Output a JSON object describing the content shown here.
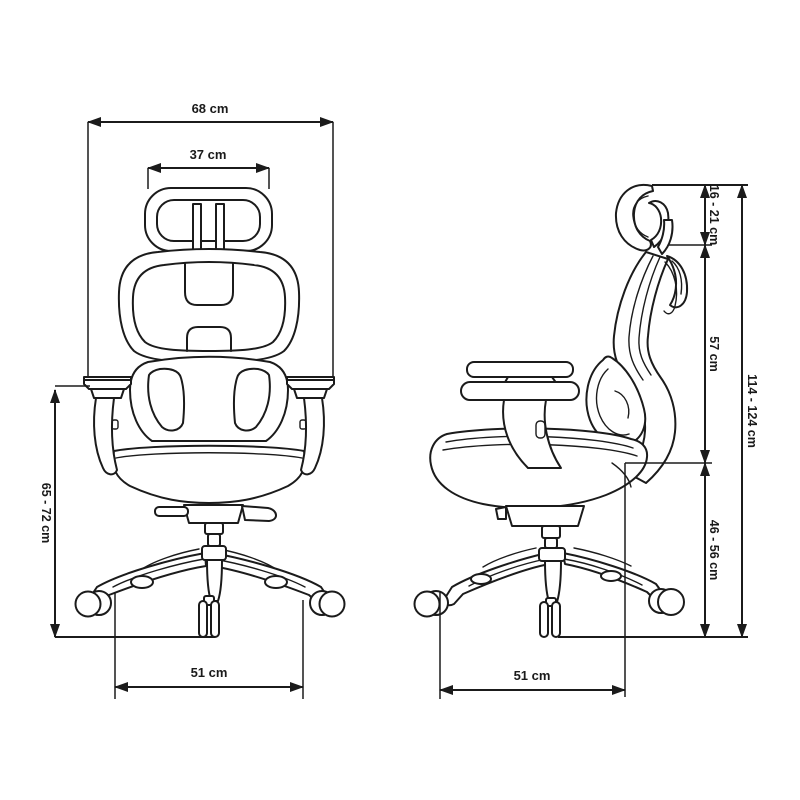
{
  "colors": {
    "line": "#1b1b1b",
    "background": "#ffffff",
    "text": "#1a1a1a"
  },
  "dimensions": {
    "overall_width": {
      "label": "68 cm"
    },
    "headrest_width": {
      "label": "37 cm"
    },
    "armrest_height_range": {
      "label": "65 - 72 cm"
    },
    "front_base_width": {
      "label": "51 cm"
    },
    "headrest_adjust_range": {
      "label": "16 - 21 cm"
    },
    "backrest_height": {
      "label": "57 cm"
    },
    "overall_height_range": {
      "label": "114 - 124 cm"
    },
    "seat_height_range": {
      "label": "46 - 56 cm"
    },
    "side_base_depth": {
      "label": "51 cm"
    }
  }
}
